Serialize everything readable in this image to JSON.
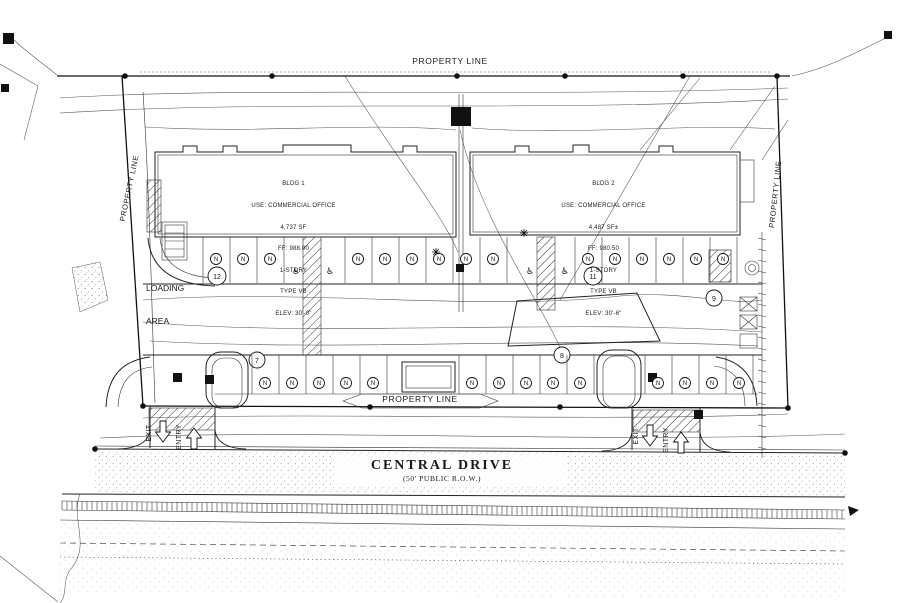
{
  "labels": {
    "property_line_top": "PROPERTY LINE",
    "property_line_left": "PROPERTY LINE",
    "property_line_right": "PROPERTY LINE",
    "property_line_bottom": "PROPERTY LINE",
    "loading_line1": "LOADING",
    "loading_line2": "AREA",
    "street_name": "CENTRAL DRIVE",
    "street_row": "(50' PUBLIC R.O.W.)",
    "exit": "EXIT",
    "entry": "ENTRY"
  },
  "buildings": {
    "bldg1": {
      "name": "BLDG 1",
      "use": "USE: COMMERCIAL OFFICE",
      "area": "4,737 SF",
      "finish_floor": "FF: 988.00",
      "stories": "1-STORY",
      "construction_type": "TYPE VB",
      "elevation": "ELEV: 30'-0\""
    },
    "bldg2": {
      "name": "BLDG 2",
      "use": "USE: COMMERCIAL OFFICE",
      "area": "4,487 SF±",
      "finish_floor": "FF: 980.50",
      "stories": "1-STORY",
      "construction_type": "TYPE VB",
      "elevation": "ELEV: 30'-6\""
    }
  },
  "keynotes": {
    "n7": "7",
    "n8": "8",
    "n9": "9",
    "n11": "11",
    "n12": "12"
  },
  "symbols": {
    "parking_stall": "N",
    "accessible": "♿"
  },
  "colors": {
    "line": "#1a1a1a",
    "contour": "#555555",
    "paper": "#ffffff"
  }
}
